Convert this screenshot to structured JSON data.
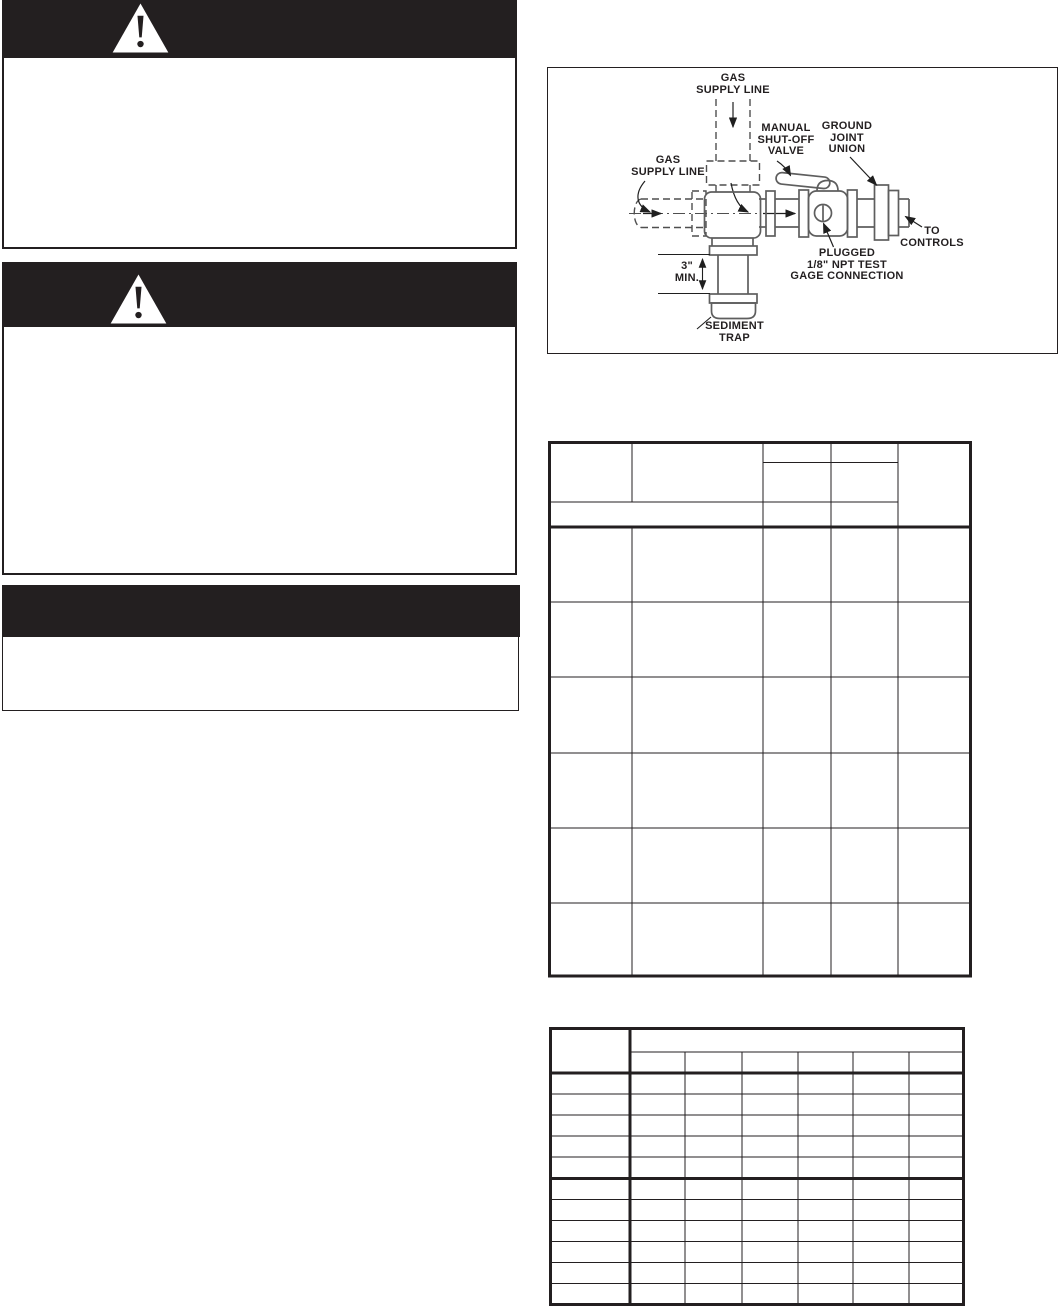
{
  "page": {
    "kind": "installation manual page (all paragraph text blank/redacted)",
    "background": "#ffffff",
    "ink": "#231f20"
  },
  "warning_blocks": [
    {
      "icon": "warning-triangle",
      "header_text": "",
      "body_text": ""
    },
    {
      "icon": "warning-triangle",
      "header_text": "",
      "body_text": ""
    }
  ],
  "notice_block": {
    "header_text": "",
    "body_text": ""
  },
  "diagram": {
    "caption": "",
    "line_color": "#5e5e5e",
    "label_color": "#231f20",
    "labels": {
      "gas_supply_top": "GAS\nSUPPLY LINE",
      "manual_shutoff_valve": "MANUAL\nSHUT-OFF\nVALVE",
      "ground_joint_union": "GROUND\nJOINT\nUNION",
      "gas_supply_left": "GAS\nSUPPLY LINE",
      "to_controls": "TO\nCONTROLS",
      "plugged_test_gage": "PLUGGED\n1/8\" NPT TEST\nGAGE CONNECTION",
      "min_dimension": "3\"\nMIN.",
      "sediment_trap": "SEDIMENT\nTRAP"
    }
  },
  "table_1": {
    "visible_text": "",
    "columns": 5,
    "header_rows": 2,
    "data_rows": 6
  },
  "table_2": {
    "visible_text": "",
    "columns": 7,
    "header_rows": 2,
    "data_rows": 11
  }
}
